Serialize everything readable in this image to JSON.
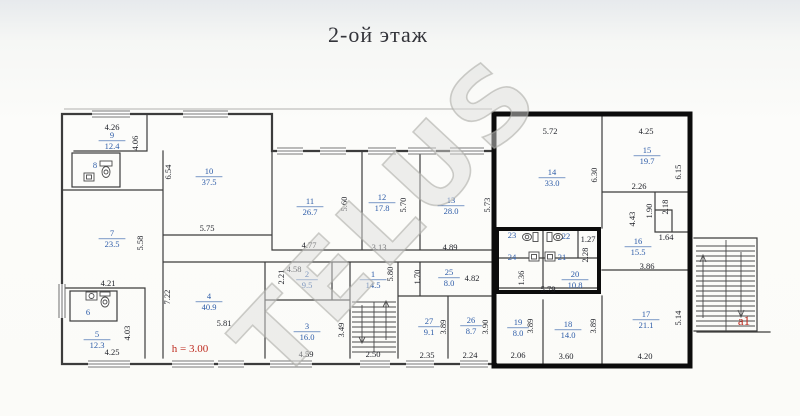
{
  "title": "2-ой этаж",
  "watermark": "TELUS",
  "notes": {
    "height_note": "h = 3.00",
    "stair_label": "a1"
  },
  "colors": {
    "room_label_blue": "#2d5ca8",
    "dimension_text": "#1d1f26",
    "accent_red": "#bf2c20",
    "wall": "#3c3c3c",
    "highlight_border": "#0c0c0c"
  },
  "rooms": [
    {
      "num": "9",
      "area": "12.4",
      "x": 112,
      "y": 140
    },
    {
      "num": "8",
      "x": 95,
      "y": 165
    },
    {
      "num": "10",
      "area": "37.5",
      "x": 209,
      "y": 176
    },
    {
      "num": "7",
      "area": "23.5",
      "x": 112,
      "y": 238
    },
    {
      "num": "6",
      "x": 88,
      "y": 312
    },
    {
      "num": "5",
      "area": "12.3",
      "x": 97,
      "y": 339
    },
    {
      "num": "4",
      "area": "40.9",
      "x": 209,
      "y": 301
    },
    {
      "num": "11",
      "area": "26.7",
      "x": 310,
      "y": 206
    },
    {
      "num": "12",
      "area": "17.8",
      "x": 382,
      "y": 202
    },
    {
      "num": "13",
      "area": "28.0",
      "x": 451,
      "y": 205
    },
    {
      "num": "2",
      "area": "9.5",
      "x": 307,
      "y": 279
    },
    {
      "num": "1",
      "area": "14.5",
      "x": 373,
      "y": 279
    },
    {
      "num": "3",
      "area": "16.0",
      "x": 307,
      "y": 331
    },
    {
      "num": "25",
      "area": "8.0",
      "x": 449,
      "y": 277
    },
    {
      "num": "27",
      "area": "9.1",
      "x": 429,
      "y": 326
    },
    {
      "num": "26",
      "area": "8.7",
      "x": 471,
      "y": 325
    },
    {
      "num": "14",
      "area": "33.0",
      "x": 552,
      "y": 177
    },
    {
      "num": "15",
      "area": "19.7",
      "x": 647,
      "y": 155
    },
    {
      "num": "16",
      "area": "15.5",
      "x": 638,
      "y": 246
    },
    {
      "num": "17",
      "area": "21.1",
      "x": 646,
      "y": 319
    },
    {
      "num": "18",
      "area": "14.0",
      "x": 568,
      "y": 329
    },
    {
      "num": "19",
      "area": "8.0",
      "x": 518,
      "y": 327
    },
    {
      "num": "20",
      "area": "10.8",
      "x": 575,
      "y": 279
    },
    {
      "num": "23",
      "x": 512,
      "y": 235
    },
    {
      "num": "22",
      "x": 566,
      "y": 236
    },
    {
      "num": "24",
      "x": 512,
      "y": 257
    },
    {
      "num": "21",
      "x": 562,
      "y": 257
    }
  ],
  "dimensions": [
    {
      "v": "4.26",
      "x": 112,
      "y": 127
    },
    {
      "v": "5.75",
      "x": 207,
      "y": 228
    },
    {
      "v": "4.21",
      "x": 108,
      "y": 283
    },
    {
      "v": "4.25",
      "x": 112,
      "y": 352
    },
    {
      "v": "5.81",
      "x": 224,
      "y": 323
    },
    {
      "v": "4.77",
      "x": 309,
      "y": 245
    },
    {
      "v": "3.13",
      "x": 379,
      "y": 247
    },
    {
      "v": "4.89",
      "x": 450,
      "y": 247
    },
    {
      "v": "4.58",
      "x": 294,
      "y": 269
    },
    {
      "v": "4.59",
      "x": 306,
      "y": 354
    },
    {
      "v": "2.50",
      "x": 373,
      "y": 354
    },
    {
      "v": "4.82",
      "x": 472,
      "y": 278
    },
    {
      "v": "2.35",
      "x": 427,
      "y": 355
    },
    {
      "v": "2.24",
      "x": 470,
      "y": 355
    },
    {
      "v": "5.72",
      "x": 550,
      "y": 131
    },
    {
      "v": "4.25",
      "x": 646,
      "y": 131
    },
    {
      "v": "2.26",
      "x": 639,
      "y": 186
    },
    {
      "v": "1.64",
      "x": 666,
      "y": 237
    },
    {
      "v": "3.86",
      "x": 647,
      "y": 266
    },
    {
      "v": "5.79",
      "x": 548,
      "y": 289
    },
    {
      "v": "1.27",
      "x": 588,
      "y": 239
    },
    {
      "v": "2.06",
      "x": 518,
      "y": 355
    },
    {
      "v": "3.60",
      "x": 566,
      "y": 356
    },
    {
      "v": "4.20",
      "x": 645,
      "y": 356
    },
    {
      "v": "4.06",
      "x": 135,
      "y": 143,
      "r": -90
    },
    {
      "v": "6.54",
      "x": 168,
      "y": 172,
      "r": -90
    },
    {
      "v": "5.58",
      "x": 140,
      "y": 243,
      "r": -90
    },
    {
      "v": "4.03",
      "x": 127,
      "y": 333,
      "r": -90
    },
    {
      "v": "7.22",
      "x": 167,
      "y": 297,
      "r": -90
    },
    {
      "v": "2.21",
      "x": 281,
      "y": 277,
      "r": -90
    },
    {
      "v": "5.60",
      "x": 344,
      "y": 204,
      "r": -90
    },
    {
      "v": "5.70",
      "x": 403,
      "y": 205,
      "r": -90
    },
    {
      "v": "5.73",
      "x": 487,
      "y": 205,
      "r": -90
    },
    {
      "v": "5.80",
      "x": 390,
      "y": 274,
      "r": -90
    },
    {
      "v": "1.70",
      "x": 417,
      "y": 277,
      "r": -90
    },
    {
      "v": "3.49",
      "x": 341,
      "y": 330,
      "r": -90
    },
    {
      "v": "3.89",
      "x": 443,
      "y": 327,
      "r": -90
    },
    {
      "v": "3.90",
      "x": 485,
      "y": 327,
      "r": -90
    },
    {
      "v": "6.30",
      "x": 594,
      "y": 175,
      "r": -90
    },
    {
      "v": "6.15",
      "x": 678,
      "y": 172,
      "r": -90
    },
    {
      "v": "4.43",
      "x": 632,
      "y": 219,
      "r": -90
    },
    {
      "v": "1.90",
      "x": 649,
      "y": 211,
      "r": -90
    },
    {
      "v": "2.18",
      "x": 665,
      "y": 207,
      "r": -90
    },
    {
      "v": "2.28",
      "x": 585,
      "y": 255,
      "r": -90
    },
    {
      "v": "1.36",
      "x": 521,
      "y": 278,
      "r": -90
    },
    {
      "v": "3.89",
      "x": 530,
      "y": 326,
      "r": -90
    },
    {
      "v": "3.89",
      "x": 593,
      "y": 326,
      "r": -90
    },
    {
      "v": "5.14",
      "x": 678,
      "y": 318,
      "r": -90
    }
  ]
}
